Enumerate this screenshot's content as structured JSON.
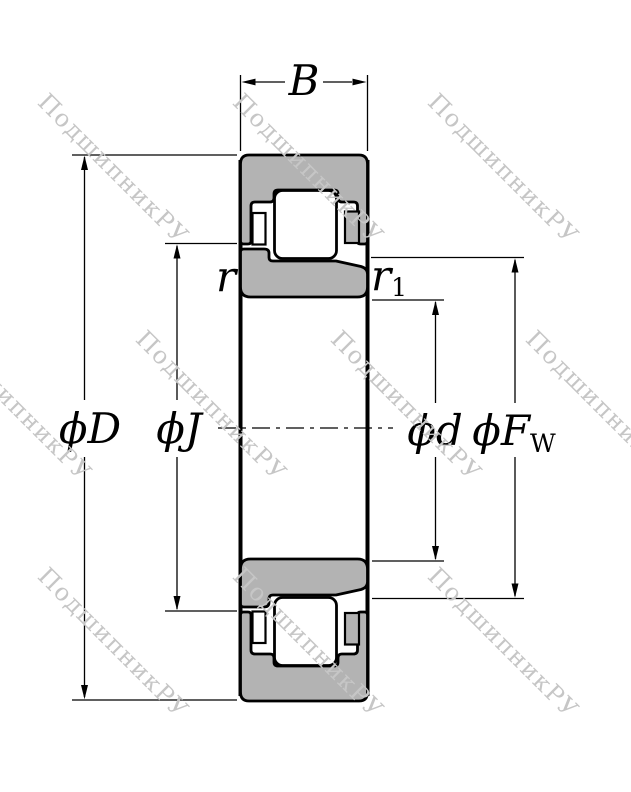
{
  "colors": {
    "background": "#ffffff",
    "ring-fill": "#b3b3b3",
    "outline": "#000000",
    "watermark-color": "#c6c6c6"
  },
  "watermark": {
    "text": "ПодшипникРУ"
  },
  "dimensions": {
    "width_label": "B",
    "outer_diameter_label": "ϕD",
    "pitch_diameter_label": "ϕJ",
    "bore_diameter_label": "ϕd",
    "raceway_diameter_label": "ϕF",
    "raceway_diameter_subscript": "W",
    "outer_chamfer_label": "r",
    "inner_chamfer_label": "r",
    "inner_chamfer_subscript": "1"
  }
}
